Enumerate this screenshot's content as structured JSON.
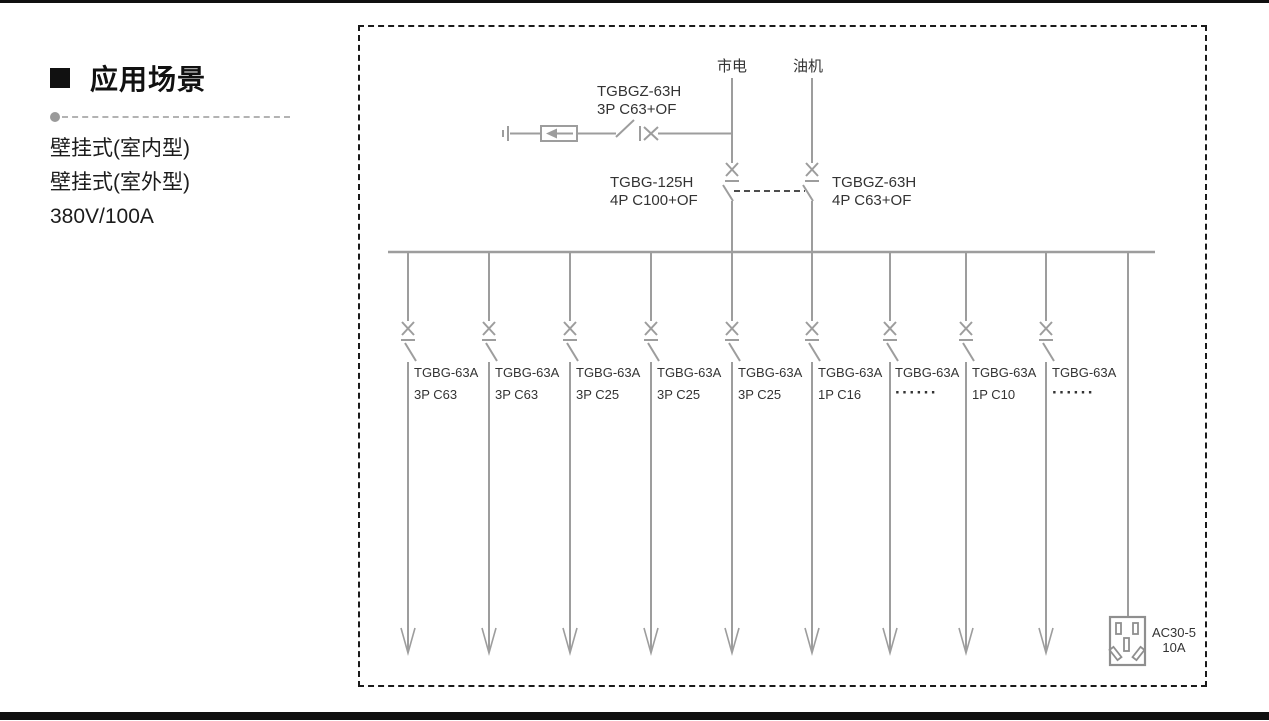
{
  "sidebar": {
    "heading": "应用场景",
    "items": [
      "壁挂式(室内型)",
      "壁挂式(室外型)",
      "380V/100A"
    ]
  },
  "diagram": {
    "sources": [
      {
        "label": "市电"
      },
      {
        "label": "油机"
      }
    ],
    "spd_breaker": {
      "model": "TGBGZ-63H",
      "spec": "3P C63+OF"
    },
    "transfer_left": {
      "model": "TGBG-125H",
      "spec": "4P C100+OF"
    },
    "transfer_right": {
      "model": "TGBGZ-63H",
      "spec": "4P C63+OF"
    },
    "branches": [
      {
        "model": "TGBG-63A",
        "spec": "3P C63"
      },
      {
        "model": "TGBG-63A",
        "spec": "3P C63"
      },
      {
        "model": "TGBG-63A",
        "spec": "3P C25"
      },
      {
        "model": "TGBG-63A",
        "spec": "3P C25"
      },
      {
        "model": "TGBG-63A",
        "spec": "3P C25"
      },
      {
        "model": "TGBG-63A",
        "spec": "1P C16"
      },
      {
        "model": "TGBG-63A",
        "spec": "······"
      },
      {
        "model": "TGBG-63A",
        "spec": "1P C10"
      },
      {
        "model": "TGBG-63A",
        "spec": "······"
      }
    ],
    "socket": {
      "model": "AC30-5",
      "rating": "10A"
    }
  },
  "icons": {
    "bullet": "black-square",
    "separator_dot": "gray-circle",
    "ground": "earth-ground",
    "spd": "surge-protector-left-arrow",
    "breaker": "switch-blade-with-x",
    "interlock": "dashed-mechanical-link",
    "load_arrow": "open-down-arrow",
    "socket": "five-hole-socket"
  },
  "colors": {
    "diagram_line": "#9d9d9d",
    "diagram_text": "#333333",
    "frame_border": "#1a1a1a",
    "separator_dash": "#b3b3b3",
    "bars": "#101010"
  }
}
